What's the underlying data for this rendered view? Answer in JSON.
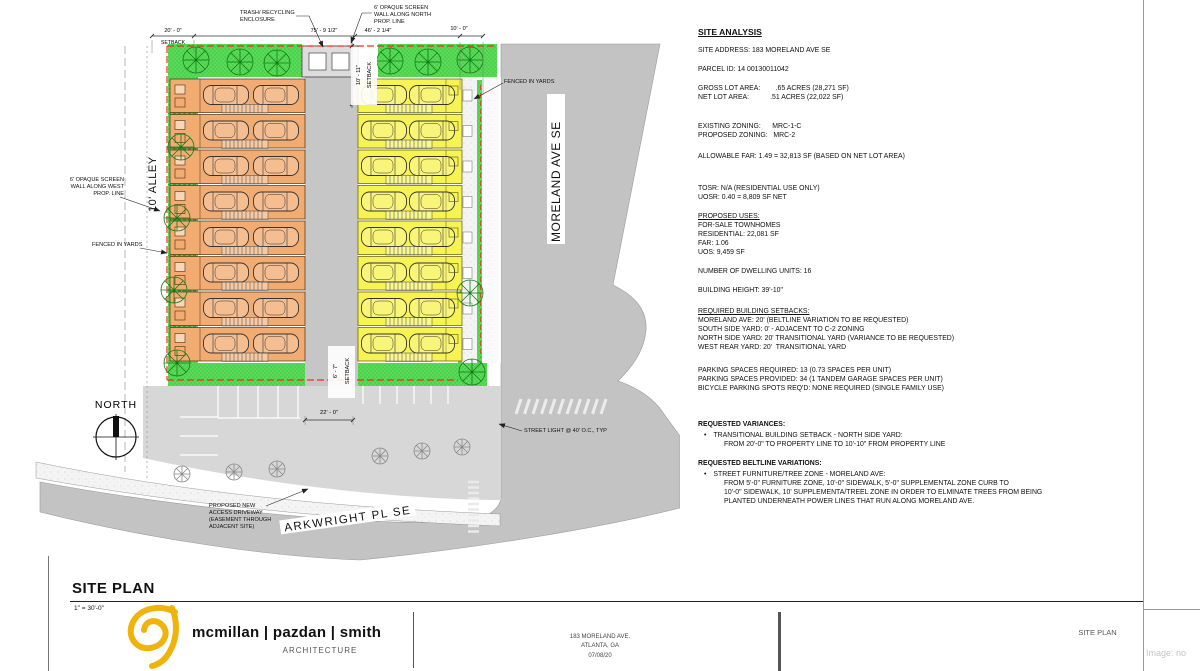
{
  "colors": {
    "green": "#58DB58",
    "green_dot": "#2EA32E",
    "orange": "#F2AC72",
    "yellow": "#F6F353",
    "road": "#C3C3C3",
    "parking": "#D7D7D7",
    "red_line": "#FF2A1A",
    "logo_yellow": "#F0B30C"
  },
  "plan": {
    "streets": {
      "alley": "10' ALLEY",
      "moreland": "MORELAND AVE SE",
      "arkwright": "ARKWRIGHT PL SE"
    },
    "labels": {
      "trash": "TRASH/ RECYCLING\nENCLOSURE",
      "wall_north": "6' OPAQUE SCREEN\nWALL ALONG NORTH\nPROP. LINE",
      "wall_west": "6' OPAQUE SCREEN\nWALL ALONG WEST\nPROP. LINE",
      "fence_left": "FENCED IN YARDS",
      "fence_right": "FENCED IN YARDS",
      "street_light": "STREET LIGHT @ 40' O.C., TYP",
      "driveway": "PROPOSED NEW\nACCESS DRIVEWAY\n(EASEMENT THROUGH\nADJACENT SITE)",
      "north": "NORTH"
    },
    "dims": {
      "d20": "20' - 0\"",
      "setback_label": "SETBACK",
      "d75": "75' - 9 1/2\"",
      "d46": "46' - 2 1/4\"",
      "d10": "10' - 0\"",
      "d1011": "10' - 11\"",
      "d67": "6' - 7\"",
      "d22": "22' - 0\""
    }
  },
  "site_analysis": {
    "rows": [
      "SITE ANALYSIS",
      "SITE ADDRESS: 183 MORELAND AVE SE",
      "PARCEL ID: 14 00130011042",
      "GROSS LOT AREA:        .65 ACRES (28,271 SF)",
      "NET LOT AREA:           .51 ACRES (22,022 SF)",
      "EXISTING ZONING:      MRC-1-C",
      "PROPOSED ZONING:   MRC-2",
      "ALLOWABLE FAR: 1.49 = 32,813 SF (BASED ON NET LOT AREA)",
      "TOSR: N/A (RESIDENTIAL USE ONLY)",
      "UOSR: 0.40 = 8,809 SF NET",
      "PROPOSED USES:",
      "FOR-SALE TOWNHOMES",
      "RESIDENTIAL: 22,081 SF",
      "FAR: 1.06",
      "UOS: 9,459 SF",
      "NUMBER OF DWELLING UNITS: 16",
      "BUILDING HEIGHT: 39'-10\"",
      "REQUIRED BUILDING SETBACKS:",
      "MORELAND AVE: 20' (BELTLINE VARIATION TO BE REQUESTED)",
      "SOUTH SIDE YARD: 0' - ADJACENT TO C-2 ZONING",
      "NORTH SIDE YARD: 20' TRANSITIONAL YARD (VARIANCE TO BE REQUESTED)",
      "WEST REAR YARD: 20'  TRANSITIONAL YARD",
      "PARKING SPACES REQUIRED: 13 (0.73 SPACES PER UNIT)",
      "PARKING SPACES PROVIDED: 34 (1 TANDEM GARAGE SPACES PER UNIT)",
      "BICYCLE PARKING SPOTS REQ'D: NONE REQUIRED (SINGLE FAMILY USE)",
      "REQUESTED VARIANCES:",
      "TRANSITIONAL BUILDING SETBACK - NORTH SIDE YARD:",
      "FROM 20'-0\" TO PROPERTY LINE TO 10'-10\" FROM PROPERTY LINE",
      "REQUESTED BELTLINE VARIATIONS:",
      "STREET FURNITURE/TREE ZONE - MORELAND AVE:",
      "FROM 5'-0\" FURNITURE ZONE, 10'-0\" SIDEWALK, 5'-0\" SUPPLEMENTAL ZONE CURB TO",
      "10'-0\" SIDEWALK, 10' SUPPLEMENTA/TREEL ZONE IN ORDER TO ELMINATE TREES FROM BEING",
      "PLANTED UNDERNEATH POWER LINES THAT RUN ALONG MORELAND AVE."
    ]
  },
  "titleblock": {
    "title": "SITE PLAN",
    "scale": "1\" = 30'-0\"",
    "firm": "mcmillan | pazdan | smith",
    "firm_sub": "ARCHITECTURE",
    "address1": "183 MORELAND AVE.",
    "address2": "ATLANTA, GA",
    "date": "07/08/20",
    "sheet_name": "SITE PLAN",
    "watermark": "Image: no"
  }
}
